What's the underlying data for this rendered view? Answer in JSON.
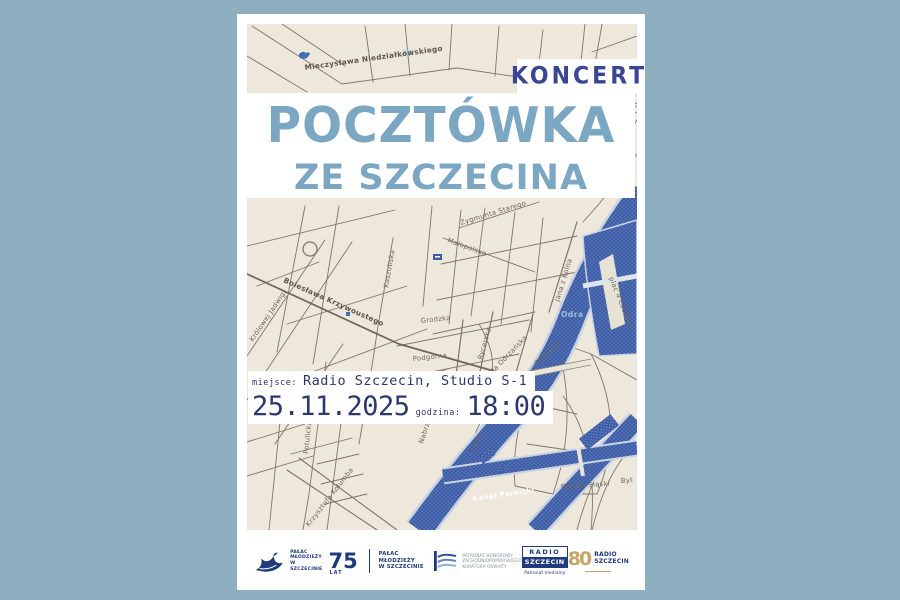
{
  "background_color": "#8EAFC0",
  "poster": {
    "koncert_label": "KONCERT",
    "title_line1": "POCZTÓWKA",
    "title_line2": "ZE SZCZECINA",
    "info": {
      "miejsce_label": "miejsce:",
      "miejsce_value": "Radio Szczecin, Studio S-1",
      "date": "25.11.2025",
      "godzina_label": "godzina:",
      "time": "18:00"
    }
  },
  "map": {
    "labels": [
      {
        "text": "Mieczysława Niedziałkowskiego"
      },
      {
        "text": "Zygmunta Starego"
      },
      {
        "text": "Małopolska"
      },
      {
        "text": "Jana z Kolna"
      },
      {
        "text": "Kaszubska"
      },
      {
        "text": "Bolesława Krzywoustego"
      },
      {
        "text": "Królowej Jadwigi"
      },
      {
        "text": "Potulicka"
      },
      {
        "text": "Rycerska"
      },
      {
        "text": "Grodzka"
      },
      {
        "text": "Podgórna"
      },
      {
        "text": "Mała Odrzańska"
      },
      {
        "text": "Zbożowa"
      },
      {
        "text": "Celna"
      },
      {
        "text": "Krzysztofa Kolumba"
      },
      {
        "text": "Nabrzeże"
      },
      {
        "text": "Bulwar Śląski"
      },
      {
        "text": "Byt"
      },
      {
        "text": "plac 4 Czerwca"
      }
    ],
    "odra_label": "Odra",
    "kanal_label": "Kanał Parnicki"
  },
  "logos": {
    "palac": {
      "lines": [
        "PAŁAC",
        "MŁODZIEŻY",
        "W SZCZECINIE"
      ]
    },
    "lat75": {
      "number": "75",
      "unit": "LAT",
      "lines": [
        "PAŁAC MŁODZIEŻY",
        "W SZCZECINIE"
      ]
    },
    "patronat": {
      "lines": [
        "PATRONAT HONOROWY",
        "ZACHODNIOPOMORSKIEGO",
        "KURATORA OŚWIATY"
      ]
    },
    "radio_patron": {
      "line1": "RADIO",
      "line2": "SZCZECIN",
      "sub": "Patronat medialny"
    },
    "radio80": {
      "number": "80",
      "line1": "RADIO",
      "line2": "SZCZECIN"
    }
  },
  "colors": {
    "title_blue": "#7CA7C2",
    "koncert_navy": "#3A4692",
    "info_navy": "#2C3870",
    "water_blue": "#3D5CA6",
    "map_cream": "#EDE8DB",
    "logo_navy": "#203B7C",
    "gold": "#C6A568"
  }
}
